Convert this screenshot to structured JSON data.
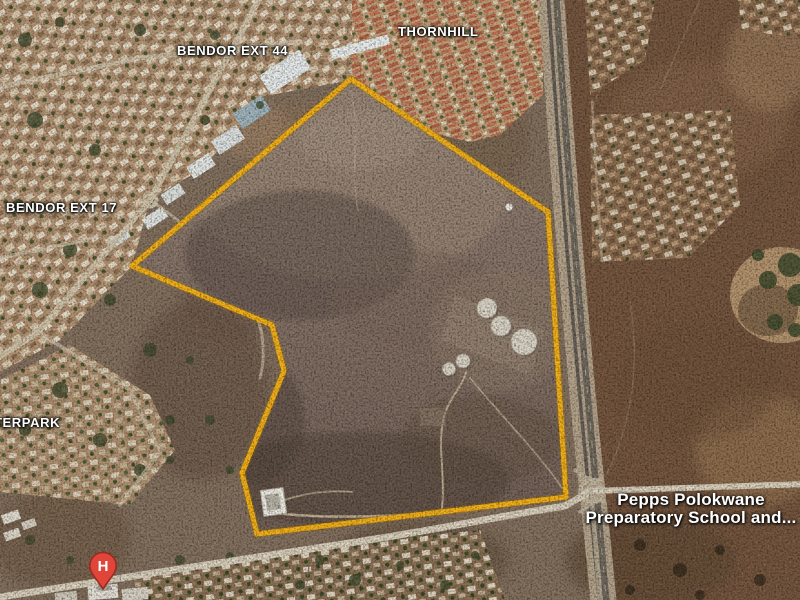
{
  "map": {
    "region_labels": [
      {
        "text": "BENDOR EXT 44"
      },
      {
        "text": "THORNHILL"
      },
      {
        "text": "BENDOR EXT 17"
      },
      {
        "text": "TERPARK"
      }
    ],
    "poi": {
      "name_line1": "Pepps Polokwane",
      "name_line2": "Preparatory School and..."
    },
    "pin": {
      "label": "H",
      "color": "#E04539"
    },
    "boundary": {
      "color": "#F2B018",
      "points": "351,79 548,212 566,497 257,534 242,473 284,371 272,325 132,266"
    }
  }
}
